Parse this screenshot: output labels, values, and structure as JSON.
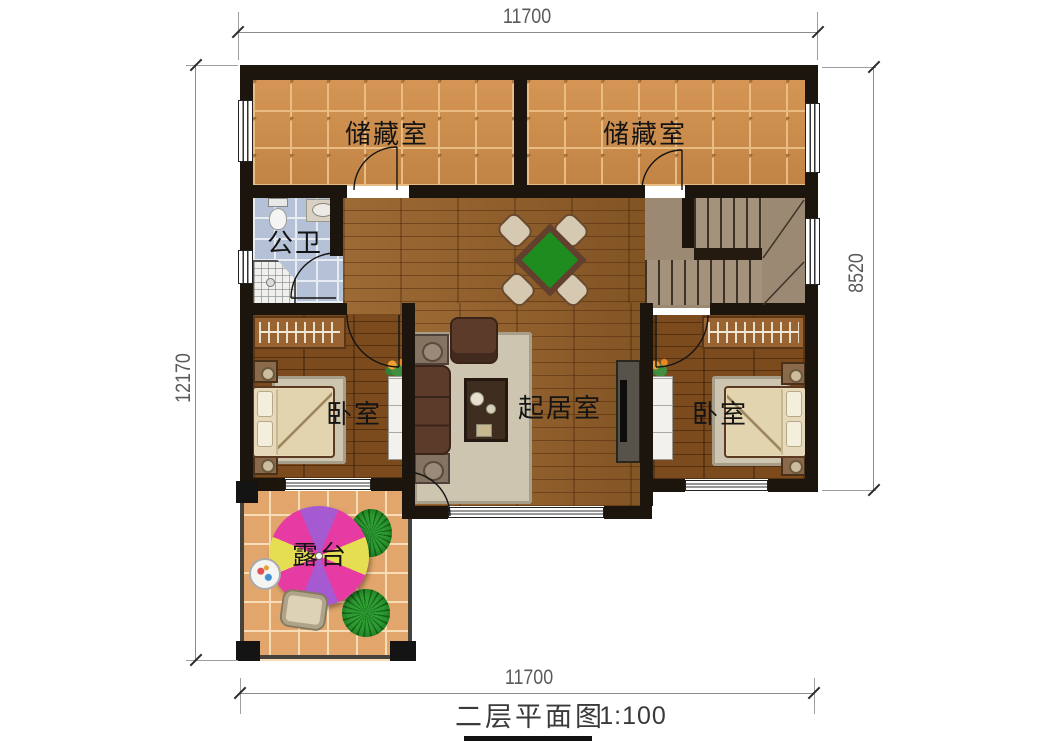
{
  "title": {
    "caption": "二层平面图",
    "scale": "1:100"
  },
  "dimensions": {
    "top": "11700",
    "bottom": "11700",
    "left": "12170",
    "right": "8520"
  },
  "rooms": {
    "storage_left": "储藏室",
    "storage_right": "储藏室",
    "bathroom": "公卫",
    "bedroom_left": "卧室",
    "living_room": "起居室",
    "bedroom_right": "卧室",
    "terrace": "露台"
  },
  "colors": {
    "wall": "#1b150e",
    "wood_floor": "#915d28",
    "bedroom_floor": "#7b4a1d",
    "storage_tile": "#d28f4a",
    "bathroom_tile": "#b4c1d6",
    "terrace_tile": "#e2a56b",
    "stair_stone": "#a5927d",
    "game_table_green": "#1f8c1f",
    "umbrella_pink": "#e73ba4",
    "umbrella_purple": "#a55ad2",
    "umbrella_yellow": "#e6de52",
    "bush_green": "#2f9e33",
    "dimension_text": "#5a5a5a"
  }
}
